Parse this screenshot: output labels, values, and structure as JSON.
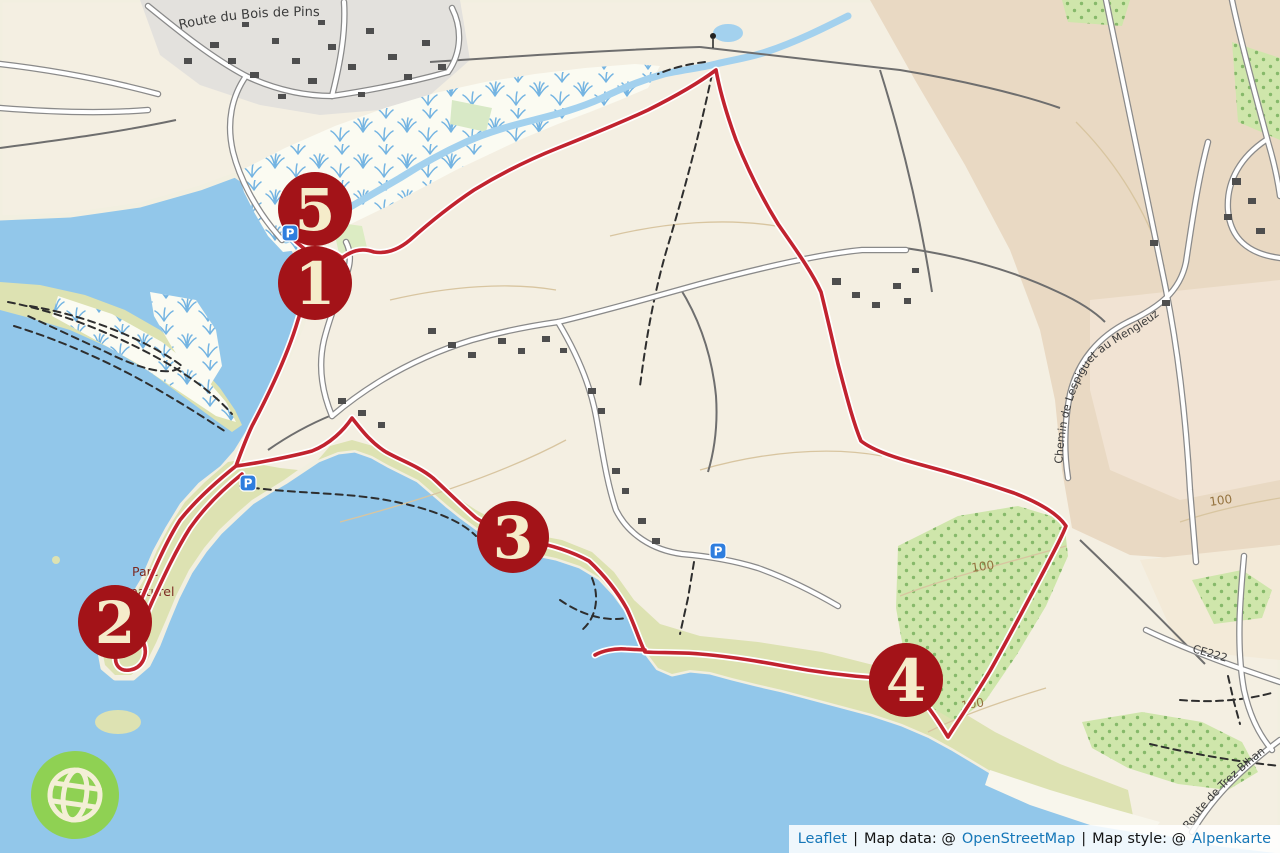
{
  "map": {
    "markers": [
      {
        "label": "1"
      },
      {
        "label": "2"
      },
      {
        "label": "3"
      },
      {
        "label": "4"
      },
      {
        "label": "5"
      }
    ],
    "road_labels": {
      "bois_de_pins": "Route du Bois de Pins",
      "lespiguet": "Chemin de Lespiguet au Mengleuz",
      "trez_bihan": "Route de Trez Bihan",
      "ce222": "CE222"
    },
    "contour_labels": [
      "100",
      "100",
      "100"
    ],
    "area_labels": {
      "parc_line1": "Parc",
      "parc_line2": "naturel"
    },
    "symbols": {
      "parking": "P"
    },
    "colors": {
      "sea": "#92c7ea",
      "land": "#f4efe2",
      "coastal_grass": "#dde2b2",
      "forest": "#cfe6ab",
      "forest_dots": "#86b96a",
      "farmland_brown": "#e9d9c3",
      "residential_gray": "#e3e1dd",
      "route_red": "#c1232f",
      "marker_red": "#a31318",
      "marker_text": "#f5ecca",
      "stream_blue": "#a3d1ee",
      "logo_green": "#8fd153",
      "parking_blue": "#2f7ede",
      "link_blue": "#1677b8"
    }
  },
  "attribution": {
    "leaflet": "Leaflet",
    "sep1": "|",
    "data_prefix": "Map data: @",
    "osm": "OpenStreetMap",
    "sep2": "|",
    "style_prefix": "Map style: @",
    "alpenkarte": "Alpenkarte"
  }
}
